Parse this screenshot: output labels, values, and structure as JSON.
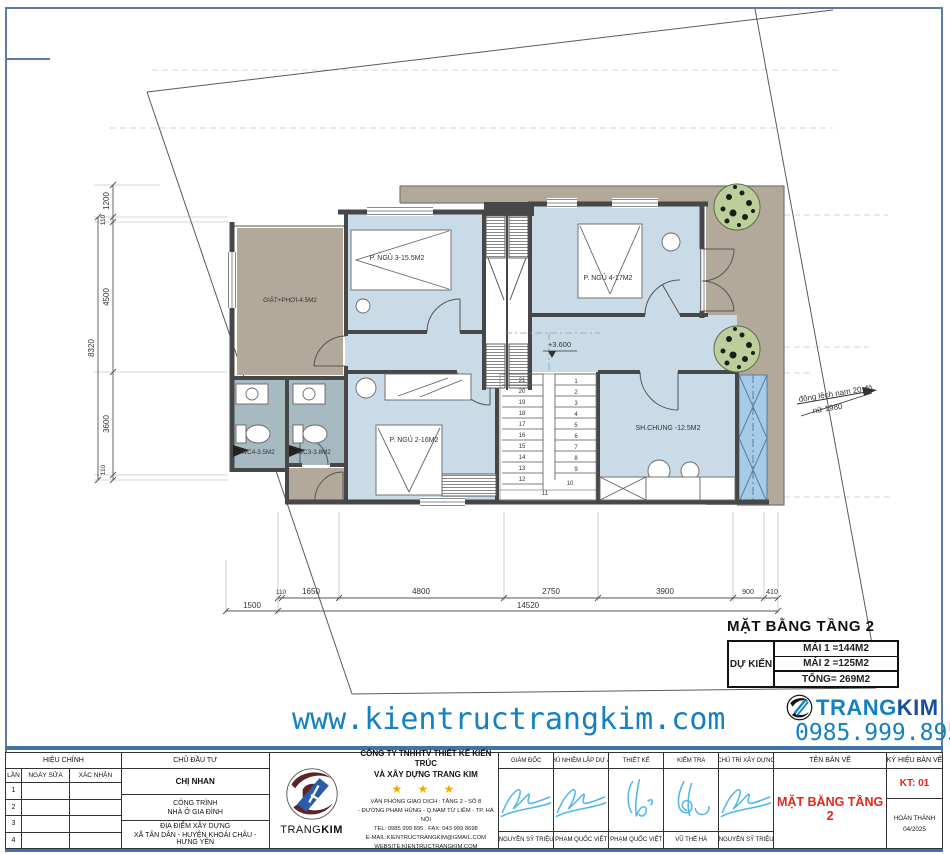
{
  "colors": {
    "room_blue": "#c8dbe6",
    "wc_blue": "#a7b9c1",
    "terrace_tan": "#b2a99b",
    "shaft_blue": "#a6cbe7",
    "accent_blue": "#1481c2",
    "red": "#e8231a",
    "signature_blue": "#54b7e9",
    "frame_blue": "#3f74ab"
  },
  "plan": {
    "rooms": {
      "laundry": "GIẶT+PHƠI-4.5M2",
      "bed3": "P. NGỦ 3-15.5M2",
      "bed4": "P. NGỦ 4-17M2",
      "wc4": "WC4-3.5M2",
      "wc3": "WC3-3.8M2",
      "bed2": "P. NGỦ 2-16M2",
      "living": "SH.CHUNG -12.5M2"
    },
    "level_mark": "+3.600",
    "stair_numbers_left": [
      "21",
      "20",
      "19",
      "18",
      "17",
      "16",
      "15",
      "14",
      "13",
      "12"
    ],
    "stair_numbers_right": [
      "1",
      "2",
      "3",
      "4",
      "5",
      "6",
      "7",
      "8",
      "9"
    ],
    "stair_extra": [
      "10",
      "11"
    ],
    "dims_left": {
      "overall": "8320",
      "segments": [
        "1200",
        "110",
        "4500",
        "3600",
        "110"
      ]
    },
    "dims_bottom": {
      "segments": [
        "110",
        "1650",
        "4800",
        "2750",
        "3900",
        "900",
        "410"
      ],
      "offset": "1500",
      "overall": "14520"
    },
    "direction_note_line1": "đông lệch nam 20 độ",
    "direction_note_line2": "nữ 1980",
    "title": "MẶT BẰNG TẦNG 2",
    "area_table": {
      "label": "DỰ KIẾN",
      "row1": "MÁI 1 =144M2",
      "row2": "MÁI 2 =125M2",
      "total": "TỔNG= 269M2"
    }
  },
  "watermark": {
    "website": "www.kientructrangkim.com",
    "phone": "0985.999.895",
    "brand_first": "TRANG",
    "brand_second": "KIM"
  },
  "titleblock": {
    "revision": {
      "title": "HIỆU CHỈNH",
      "col_lan": "LẦN",
      "col_ngay": "NGÀY SỬA",
      "col_xacnhan": "XÁC NHẬN",
      "rows": [
        "1",
        "2",
        "3",
        "4"
      ]
    },
    "investor": {
      "title": "CHỦ ĐẦU TƯ",
      "name": "CHỊ NHAN",
      "project_label": "CÔNG TRÌNH",
      "project_name": "NHÀ Ở GIA ĐÌNH",
      "location_label": "ĐỊA ĐIỂM XÂY DỰNG",
      "location_value": "XÃ TÂN DÂN - HUYỆN KHOÁI CHÂU - HƯNG YÊN"
    },
    "company": {
      "logo_text_a": "TRANG",
      "logo_text_b": "KIM",
      "name_line1": "CÔNG TY TNHHTV THIẾT KẾ KIẾN TRÚC",
      "name_line2": "VÀ XÂY DỰNG TRANG KIM",
      "stars": "★ ★ ★",
      "addr1": "VĂN PHÒNG GIAO DỊCH : TẦNG 2 - SỐ 8",
      "addr2": "- ĐƯỜNG PHẠM HÙNG - Q.NAM TỪ LIÊM - TP. HÀ NỘI",
      "addr3": "TEL: 0985 999 895 . FAX: 043 999 8698",
      "addr4": "E-MAIL:KIENTRUCTRANGKIM@GMAIL.COM",
      "addr5": "WEBSITE:KIENTRUCTRANGKIM.COM"
    },
    "signatures": [
      {
        "role": "GIÁM ĐỐC",
        "name": "NGUYỄN SỸ TRIỆU"
      },
      {
        "role": "CHỦ NHIỆM LẬP DỰ ÁN",
        "name": "PHẠM QUỐC VIỆT"
      },
      {
        "role": "THIẾT KẾ",
        "name": "PHẠM QUỐC VIỆT"
      },
      {
        "role": "KIỂM TRA",
        "name": "VŨ THẾ HÀ"
      },
      {
        "role": "CHỦ TRÌ XÂY DỰNG",
        "name": "NGUYỄN SỸ TRIỆU"
      }
    ],
    "drawing": {
      "title_label": "TÊN BẢN VẼ",
      "title_value": "MẶT BẰNG TẦNG 2",
      "code_label": "KÝ HIỆU BẢN VẼ",
      "code_value": "KT: 01",
      "status": "HOÀN THÀNH",
      "date": "04/2025"
    }
  }
}
